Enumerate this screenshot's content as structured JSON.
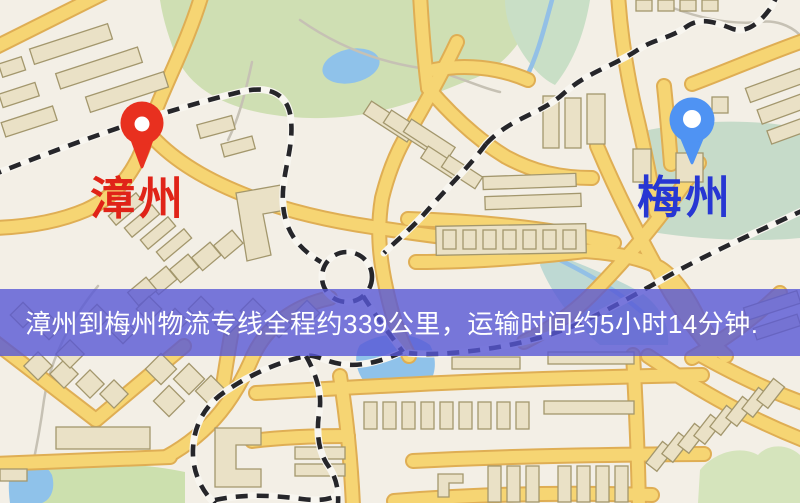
{
  "map": {
    "background_color": "#f3efe6",
    "road_color": "#f6d573",
    "road_casing_color": "#dfae54",
    "railway_color": "#26262a",
    "water_color": "#8fc2ea",
    "park_color": "#cfdfb3",
    "park_teal_color": "#c6dbc9",
    "building_fill": "#eae1c6",
    "building_stroke": "#a3976d"
  },
  "markers": [
    {
      "name": "zhangzhou",
      "label": "漳州",
      "pin_color": "#e8301f",
      "pin_hole_color": "#ffffff",
      "label_color": "#e02318"
    },
    {
      "name": "meizhou",
      "label": "梅州",
      "pin_color": "#4f93f3",
      "pin_hole_color": "#ffffff",
      "label_color": "#2737d3"
    }
  ],
  "banner": {
    "text": "漳州到梅州物流专线全程约339公里，运输时间约5小时14分钟.",
    "background_color": "rgba(88,88,214,0.80)",
    "text_color": "#ffffff"
  },
  "route_info": {
    "origin": "漳州",
    "destination": "梅州",
    "distance_text": "339公里",
    "distance_km": 339,
    "duration_text": "5小时14分钟"
  }
}
